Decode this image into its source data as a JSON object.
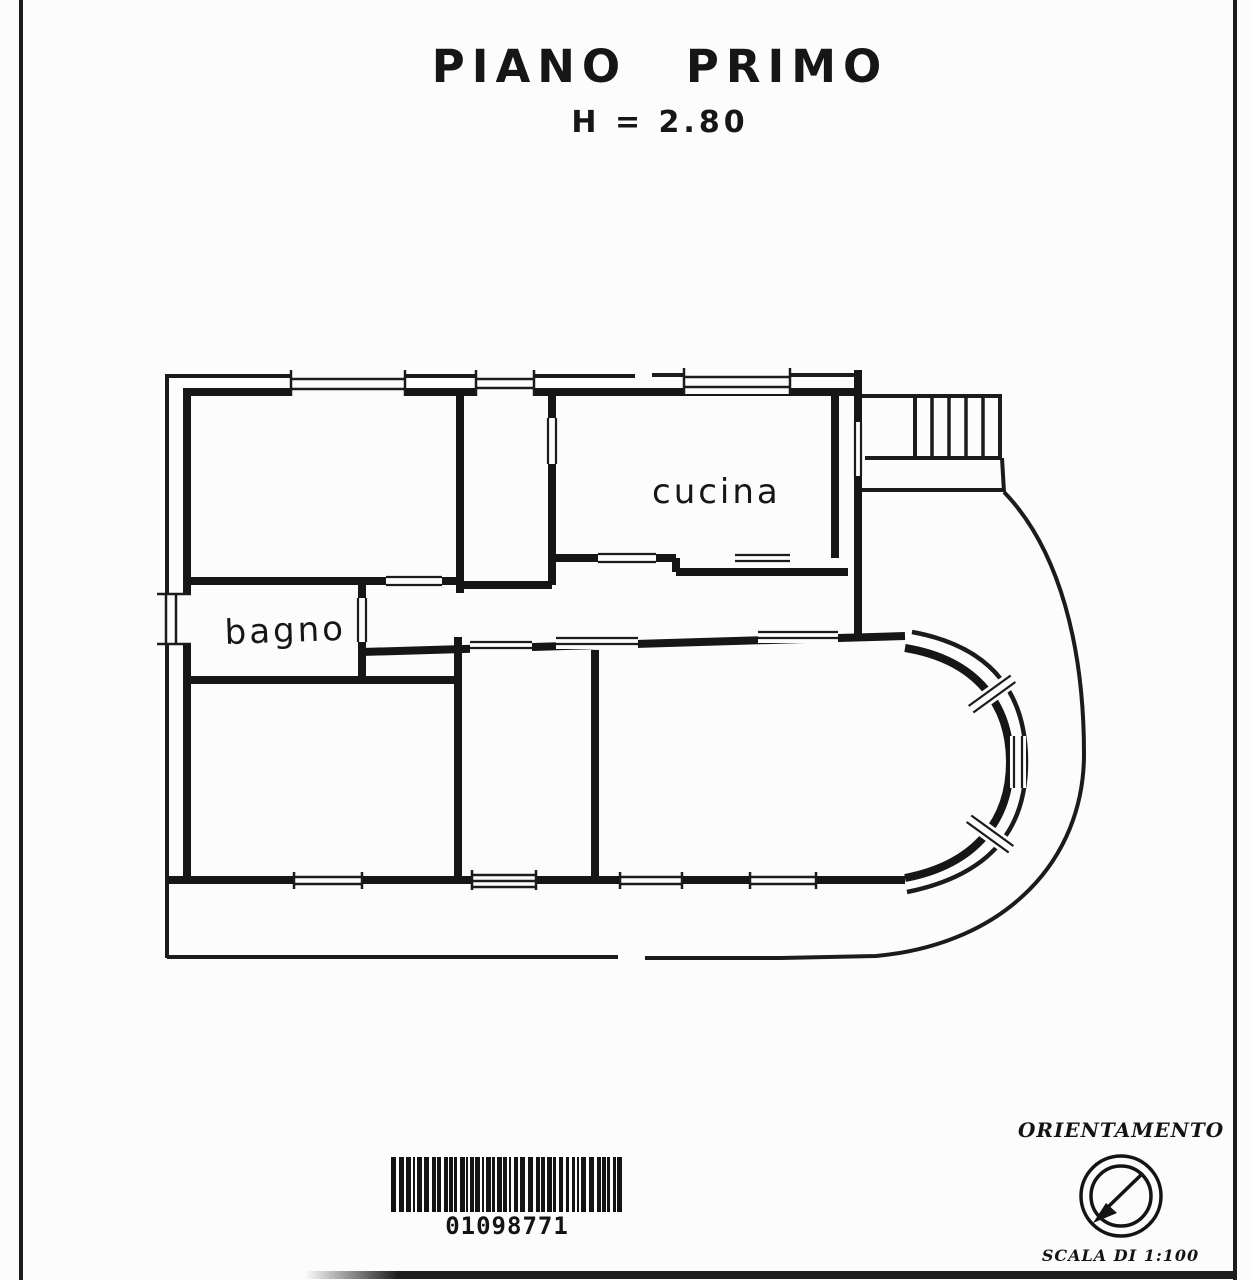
{
  "header": {
    "title": "PIANO PRIMO",
    "height_note": "H = 2.80"
  },
  "floorplan": {
    "rooms": [
      {
        "name": "cucina",
        "label": "cucina"
      },
      {
        "name": "bagno",
        "label": "bagno"
      }
    ]
  },
  "barcode": {
    "digits": "01098771"
  },
  "orientation": {
    "label": "ORIENTAMENTO",
    "scale_label": "SCALA DI 1:100",
    "icon": "compass-icon"
  },
  "colors": {
    "ink": "#1b1b1b",
    "paper": "#fcfcfc"
  }
}
